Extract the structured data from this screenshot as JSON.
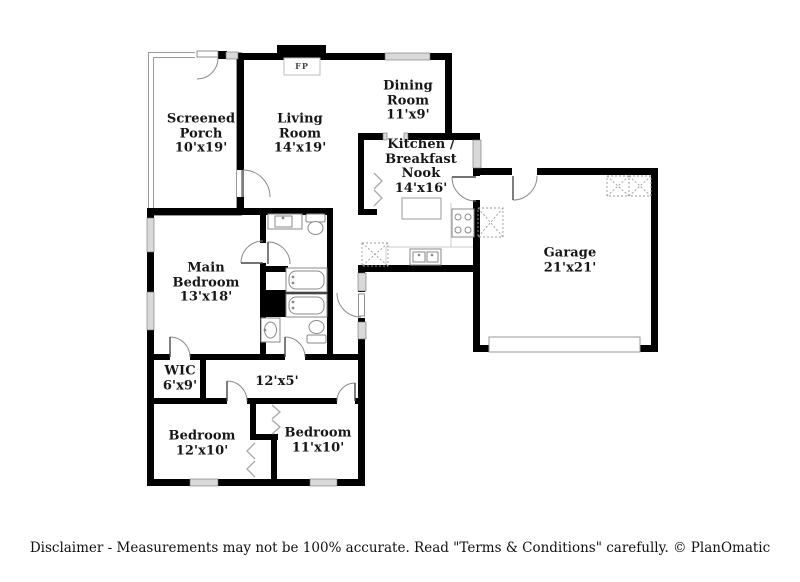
{
  "plan_title": "Residential floor plan",
  "rooms": [
    {
      "id": "screened-porch",
      "name": "Screened Porch",
      "dims": "10'x19'"
    },
    {
      "id": "living-room",
      "name": "Living Room",
      "dims": "14'x19'"
    },
    {
      "id": "dining-room",
      "name": "Dining Room",
      "dims": "11'x9'"
    },
    {
      "id": "kitchen-breakfast-nook",
      "name": "Kitchen / Breakfast Nook",
      "dims": "14'x16'"
    },
    {
      "id": "garage",
      "name": "Garage",
      "dims": "21'x21'"
    },
    {
      "id": "main-bedroom",
      "name": "Main Bedroom",
      "dims": "13'x18'"
    },
    {
      "id": "wic",
      "name": "WIC",
      "dims": "6'x9'"
    },
    {
      "id": "hallway",
      "name": "",
      "dims": "12'x5'"
    },
    {
      "id": "bedroom-left",
      "name": "Bedroom",
      "dims": "12'x10'"
    },
    {
      "id": "bedroom-right",
      "name": "Bedroom",
      "dims": "11'x10'"
    }
  ],
  "fireplace_label": "FP",
  "disclaimer": "Disclaimer - Measurements may not be 100% accurate. Read \"Terms & Conditions\" carefully. © PlanOmatic",
  "fixtures": [
    "fireplace",
    "kitchen-island",
    "stove",
    "kitchen-sink",
    "dishwasher",
    "water-heater",
    "hvac-units",
    "garage-door",
    "bathtub",
    "toilet",
    "vanity-sink",
    "closet-bifold-doors",
    "pantry-bifold-doors",
    "door-swings",
    "windows"
  ],
  "colors": {
    "wall": "#000000",
    "window_fill": "#d9d9d9",
    "fixture_stroke": "#8a8a8a",
    "text": "#161616",
    "background": "#ffffff"
  }
}
